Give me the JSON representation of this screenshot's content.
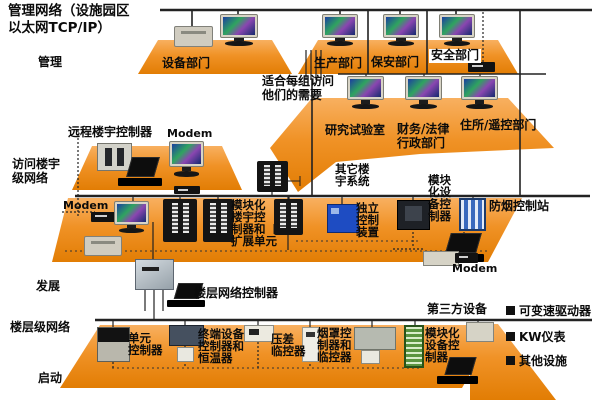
{
  "title": "管理网络（设施园区\n以太网TCP/IP）",
  "levels": {
    "management": "管理",
    "access": "访问楼宇\n级网络",
    "development": "发展",
    "floor": "楼层级网络",
    "startup": "启动"
  },
  "top": {
    "equipment_dept": "设备部门",
    "production_dept": "生产部门",
    "security_dept": "保安部门",
    "safety_dept": "安全部门",
    "note": "适合每组访问\n他们的需要",
    "research_lab": "研究试验室",
    "finance_admin": "财务/法律\n行政部门",
    "residence_remote": "住所/遥控部门"
  },
  "middle": {
    "remote_building_controller": "远程楼宇控制器",
    "modem_top": "Modem",
    "modem_left": "Modem",
    "other_building_systems": "其它楼\n宇系统",
    "modular_building_controller": "模块化\n楼宇控\n制器和\n扩展单元",
    "standalone_control": "独立\n控制\n装置",
    "modular_equipment_controller": "模块\n化设\n备控\n制器",
    "smoke_control_station": "防烟控制站",
    "modem_right": "Modem"
  },
  "development": {
    "floor_network_controller": "楼层网络控制器"
  },
  "bottom": {
    "unit_controller": "单元\n控制器",
    "terminal_controller": "终端设备\n控制器和\n恒温器",
    "pressure_monitor": "压差\n临控器",
    "hood_controller": "烟罩控\n制器和\n临控器",
    "third_party": "第三方设备",
    "modular_equipment_controller": "模块化\n设备控\n制器"
  },
  "legend": {
    "items": [
      "可变速驱动器",
      "KW仪表",
      "其他设施"
    ]
  },
  "colors": {
    "platform_orange": "#f09226",
    "platform_orange_light": "#f8b060",
    "platform_orange_dark": "#e27d04",
    "line": "#222222",
    "screen_blue": "#1c3fa0",
    "screen_green": "#2fa45f",
    "standalone_box_blue": "#1e4cc2",
    "smoke_station_blue": "#3a69bd",
    "green_cabinet": "#5a9440"
  }
}
